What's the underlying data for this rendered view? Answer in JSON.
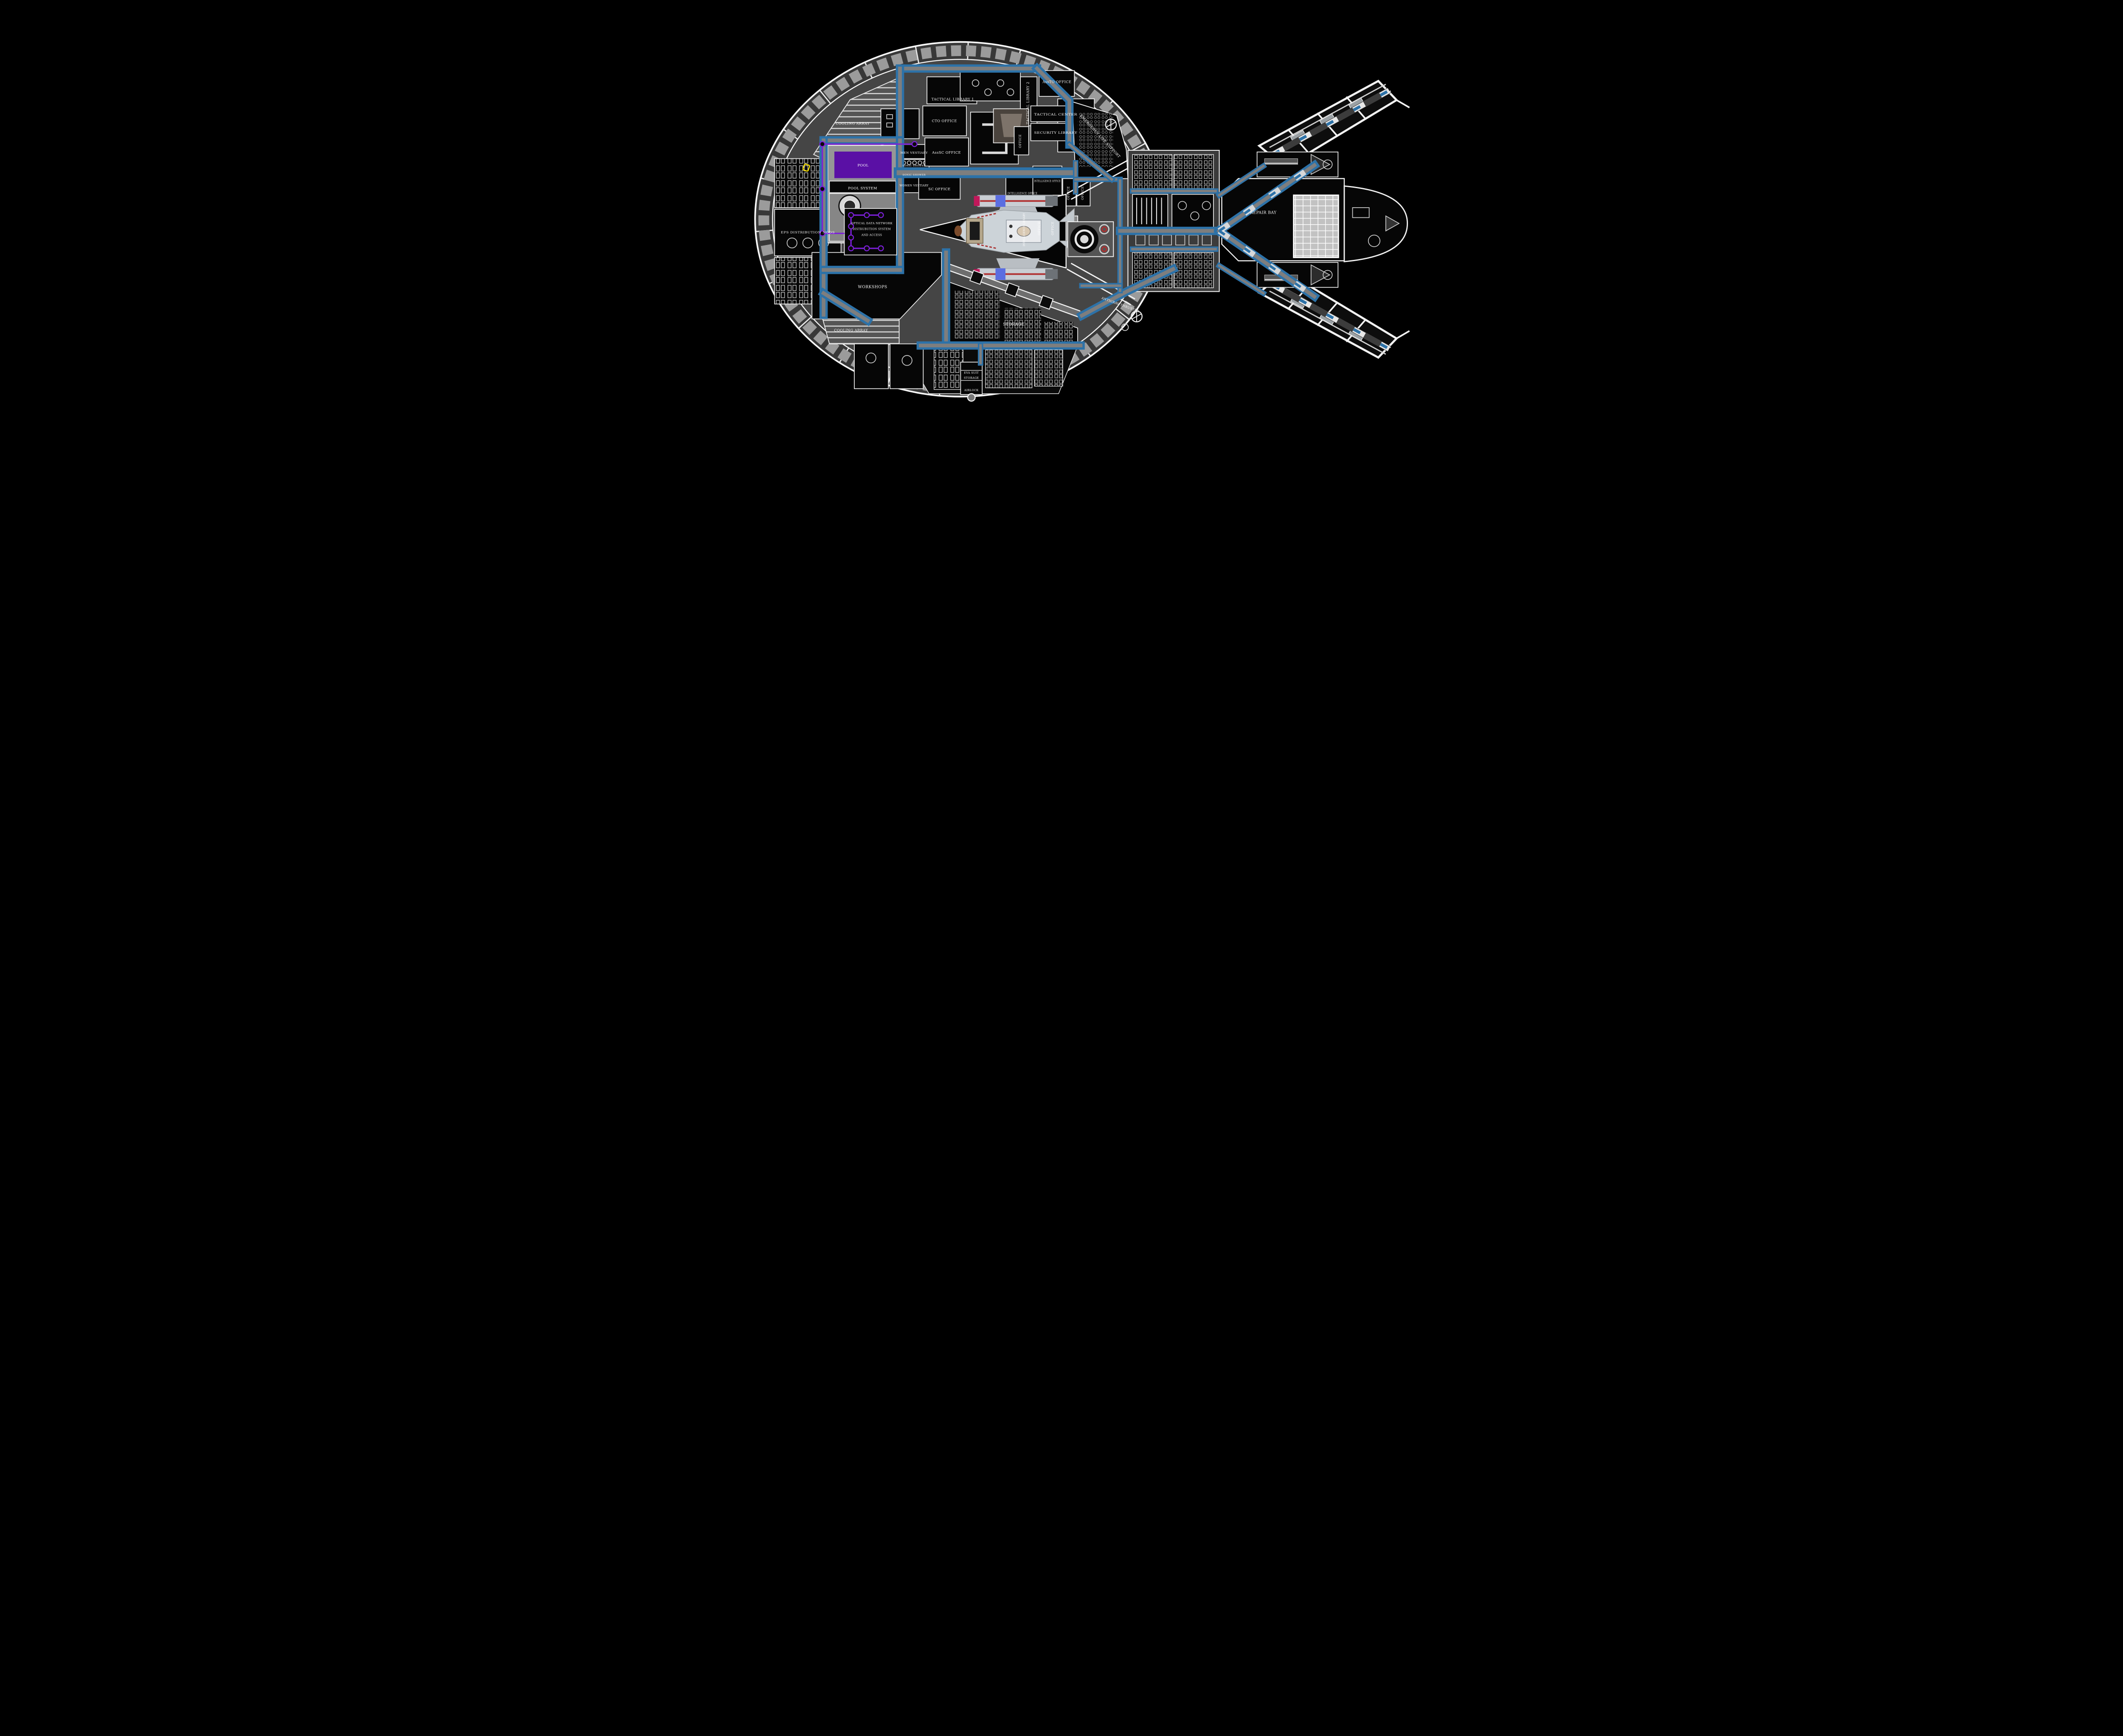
{
  "diagram": {
    "type": "starship-deck-plan-blueprint",
    "colors": {
      "background": "#000000",
      "hull_outline_white": "#f2f2f2",
      "rim_band_gray": "#383838",
      "escape_pod_gray": "#9b9b9b",
      "deck_floor_gray": "#454545",
      "room_black": "#060606",
      "corridor_blue": "#2d72a8",
      "corridor_core_gray": "#7e7e7e",
      "pool_purple": "#5a10a5",
      "odn_line_purple": "#7b1fd8",
      "shuttle_hull_gray": "#ccd3d8",
      "shuttle_stripe_red": "#b03030",
      "shuttle_band_blue": "#5b6ee1",
      "shuttle_cap_magenta": "#c2185b",
      "repair_grid_gray": "#c2c2c2",
      "highlight_yellow": "#ffe600"
    },
    "labels": {
      "tactical_library_1": "TACTICAL LIBRARY 1",
      "tactical_library_2": "TACTICAL LIBRARY 2",
      "assto_office": "AssTO OFFICE",
      "cto_office": "CTO OFFICE",
      "asssc_office": "AssSC OFFICE",
      "sc_office": "SC OFFICE",
      "tactical_center": "TACTICAL CENTER",
      "security_library": "SECURITY LIBRARY",
      "office": "OFFICE",
      "intelligence_office": "INTELLIGENCE OFFICE",
      "intelligence_library": "INTELLIGENCE LIBRARY",
      "emergency_life_support": "EMERGENCY LIFE SUPPORT",
      "men_vestiary": "MEN VESTIARY",
      "sonic_shower": "SONIC SHOWER",
      "women_vestiary": "WOMEN VESTIARY",
      "pool": "POOL",
      "pool_system": "POOL SYSTEM",
      "cooling_array": "COOLING ARRAY",
      "eps_distribution_nods": "EPS DISTRIBUTION NODS",
      "odn_line1": "OPTICAL DATA NETWORK",
      "odn_line2": "DISTRUBUTION SYSTEM",
      "odn_line3": "AND ACCESS",
      "workshops": "WORKSHOPS",
      "storage": "STORAGE",
      "eva_suit_line1": "EVA SUIT",
      "eva_suit_line2": "STORAGE",
      "airlock": "AIRLOCK",
      "repair_bay": "REPAIR BAY",
      "antigrav_thruster": "ANTIGRAV THRUSTER"
    }
  }
}
